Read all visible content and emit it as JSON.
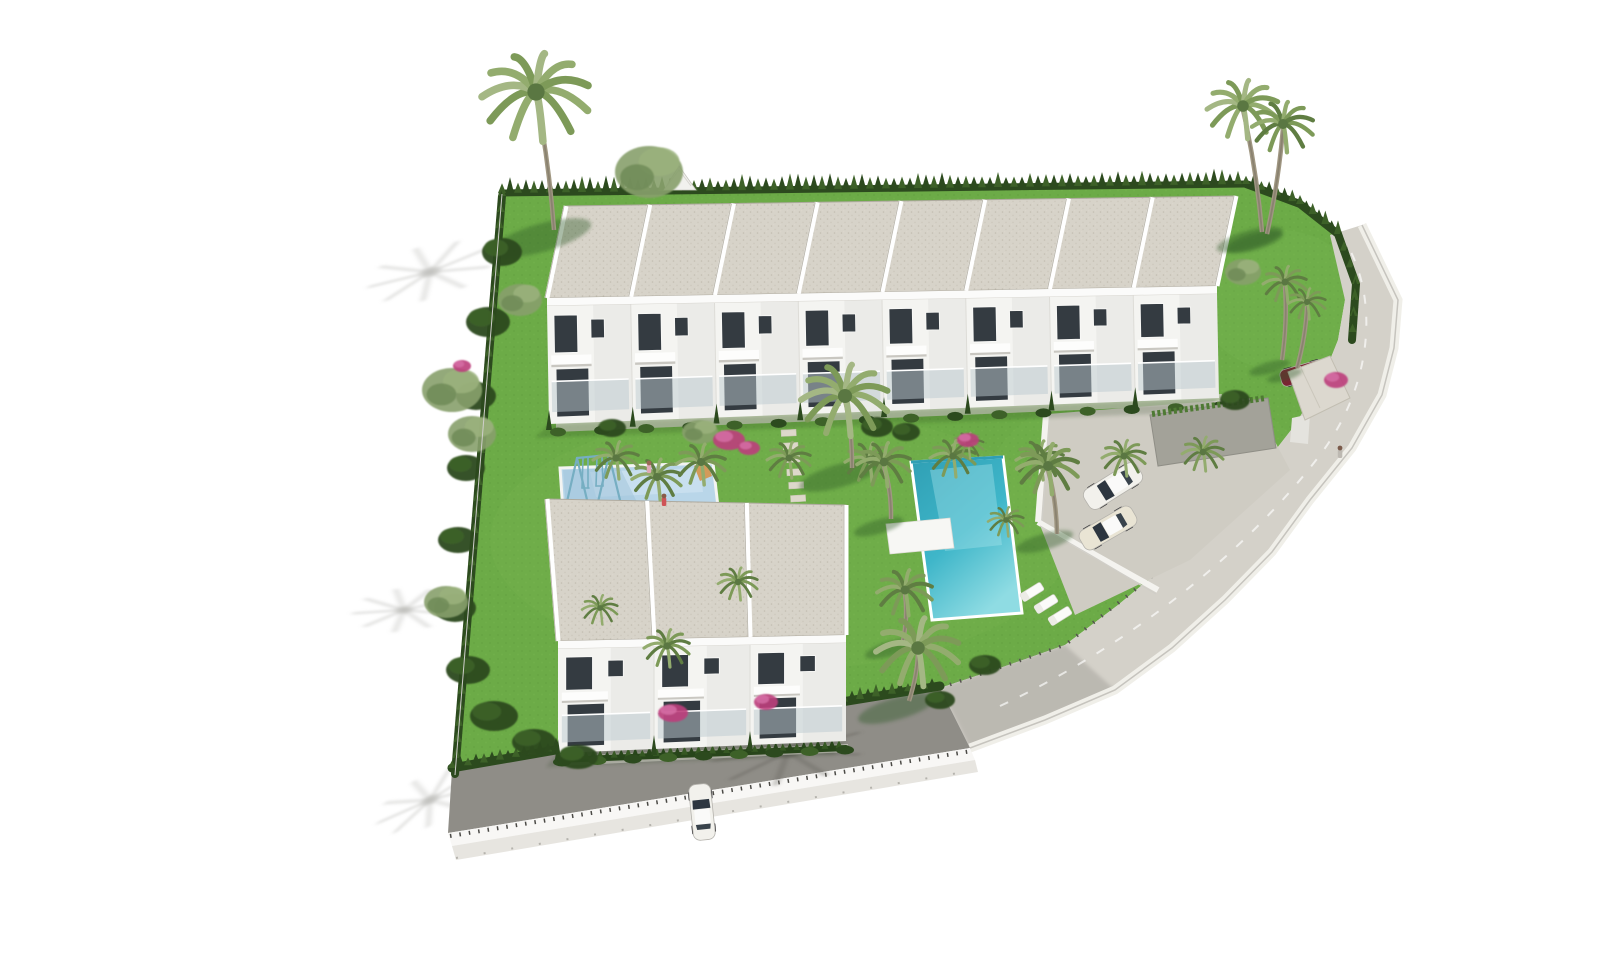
{
  "meta": {
    "description": "Aerial 3D architectural rendering of a Mediterranean residential development: a long row of 8 white two-storey townhouses, a detached block of 3 townhouses, communal turquoise pool with sun loungers, children's splash pool with swing set, landscaped gardens with palms and bougainvillea, parking court with cars, gatehouse, and a curved perimeter road on a white background.",
    "render_style": "photorealistic CGI site overview"
  },
  "colors": {
    "bg": "#ffffff",
    "grass": "#6cab47",
    "grassLight": "#82bd56",
    "grassDark": "#4e8a33",
    "hedge": "#2c4a1e",
    "hedgeLight": "#3d6128",
    "roof": "#d7d3c9",
    "roofDot": "#c3beb1",
    "roofEdge": "#aeaa9f",
    "wallWhite": "#f4f4f1",
    "wallShade": "#e4e3de",
    "window": "#343b41",
    "glassLight": "#bccad0",
    "parapet": "#fbfbfa",
    "pool": "#3fb6c9",
    "poolDeep": "#2f9fb4",
    "poolLight": "#8fdce3",
    "kidsPool": "#b9d6e9",
    "kidsPoolLight": "#d6e8f4",
    "pave": "#cfccc3",
    "road": "#d4d1c9",
    "roadDark": "#8f8d87",
    "wallFace": "#e7e5e0",
    "shadowWhite": "#bdbdba",
    "shadowRoad": "#5f5d58",
    "palmGreen": "#7d9a58",
    "palmGreenDark": "#5f7d42",
    "palmPale": "#93ac6e",
    "trunk": "#a09782",
    "trunkDark": "#8a8270",
    "boug": "#bc3f7c",
    "bougLight": "#d66fa5",
    "teal": "#76aec2",
    "carWhite": "#f2f1ec",
    "carChampagne": "#e9e4d4",
    "carRed": "#7b2433",
    "slide": "#d39a5a"
  },
  "buildings": {
    "top_row": {
      "units": 8,
      "floors": 2
    },
    "bottom_block": {
      "units": 3,
      "floors": 2
    }
  },
  "amenities": {
    "main_pool": 1,
    "kids_pool": 1,
    "swing_set": 1,
    "sun_loungers": 3,
    "stepping_stone_path": 1,
    "gatehouse": 1,
    "carport": 1
  },
  "vehicles": {
    "parking_cars": 2,
    "street_car": 1,
    "covered_car": 1
  },
  "scene": {
    "tall_palms": [
      [
        536,
        92,
        54,
        554,
        230
      ],
      [
        1243,
        106,
        36,
        1262,
        232
      ],
      [
        1283,
        124,
        31,
        1267,
        234
      ],
      [
        845,
        396,
        44,
        852,
        468
      ],
      [
        884,
        462,
        27,
        891,
        519
      ],
      [
        1048,
        466,
        31,
        1057,
        534
      ],
      [
        905,
        590,
        28,
        903,
        641
      ],
      [
        918,
        648,
        42,
        909,
        701
      ],
      [
        1285,
        282,
        22,
        1282,
        360
      ],
      [
        1307,
        302,
        19,
        1297,
        368
      ]
    ],
    "fan_palms": [
      [
        616,
        458,
        23
      ],
      [
        701,
        462,
        25
      ],
      [
        789,
        458,
        22
      ],
      [
        869,
        460,
        24
      ],
      [
        953,
        456,
        23
      ],
      [
        1040,
        458,
        24
      ],
      [
        1124,
        456,
        22
      ],
      [
        1203,
        452,
        21
      ],
      [
        657,
        477,
        25
      ],
      [
        667,
        646,
        23
      ],
      [
        968,
        444,
        16
      ],
      [
        1006,
        520,
        18
      ],
      [
        738,
        582,
        20
      ],
      [
        600,
        608,
        18
      ]
    ],
    "shrubs": [
      [
        502,
        252,
        20,
        14
      ],
      [
        488,
        322,
        22,
        15
      ],
      [
        476,
        396,
        20,
        14
      ],
      [
        466,
        468,
        19,
        13
      ],
      [
        458,
        540,
        20,
        13
      ],
      [
        455,
        608,
        21,
        14
      ],
      [
        468,
        670,
        22,
        14
      ],
      [
        494,
        716,
        24,
        15
      ],
      [
        534,
        742,
        22,
        13
      ],
      [
        578,
        757,
        20,
        12
      ],
      [
        877,
        427,
        16,
        10
      ],
      [
        906,
        432,
        14,
        9
      ],
      [
        1235,
        400,
        15,
        10
      ],
      [
        612,
        428,
        14,
        9
      ],
      [
        985,
        665,
        16,
        10
      ],
      [
        940,
        700,
        15,
        9
      ]
    ],
    "leafy": [
      [
        452,
        390,
        30,
        22
      ],
      [
        472,
        434,
        24,
        18
      ],
      [
        649,
        172,
        34,
        26
      ],
      [
        446,
        602,
        22,
        16
      ],
      [
        1243,
        272,
        18,
        13
      ],
      [
        520,
        300,
        22,
        16
      ],
      [
        700,
        432,
        18,
        12
      ]
    ],
    "bougainvillea": [
      [
        729,
        440,
        16,
        10
      ],
      [
        749,
        448,
        11,
        7
      ],
      [
        673,
        713,
        15,
        9
      ],
      [
        766,
        702,
        12,
        8
      ],
      [
        968,
        440,
        11,
        7
      ],
      [
        1336,
        380,
        12,
        8
      ],
      [
        462,
        366,
        9,
        6
      ]
    ],
    "white_shadows": [
      [
        430,
        272,
        62,
        -15
      ],
      [
        404,
        610,
        50,
        -5
      ],
      [
        430,
        800,
        56,
        -25
      ]
    ],
    "road_shadow": [
      788,
      752,
      75,
      -8
    ],
    "cars": [
      {
        "x": 1113,
        "y": 486,
        "rot": -32,
        "len": 62,
        "wid": 23,
        "body": "carWhite"
      },
      {
        "x": 1108,
        "y": 528,
        "rot": -30,
        "len": 60,
        "wid": 22,
        "body": "carChampagne"
      },
      {
        "x": 702,
        "y": 812,
        "rot": 84,
        "len": 56,
        "wid": 22,
        "body": "carWhite"
      },
      {
        "x": 1303,
        "y": 373,
        "rot": -16,
        "len": 46,
        "wid": 17,
        "body": "carRed",
        "covered": true
      }
    ],
    "loungers": [
      [
        1032,
        592
      ],
      [
        1046,
        604
      ],
      [
        1060,
        616
      ]
    ],
    "figures": [
      [
        664,
        496,
        "#8a5a48",
        "#cf5356"
      ],
      [
        1340,
        448,
        "#7a5a4a",
        "#bdb9b2"
      ],
      [
        649,
        463,
        "#9a6a55",
        "#e0a9b8"
      ]
    ],
    "steps": {
      "x": 781,
      "y": 430,
      "n": 6,
      "w": 15,
      "h": 6.5,
      "dx": 1.2,
      "dy": 13.2
    }
  }
}
